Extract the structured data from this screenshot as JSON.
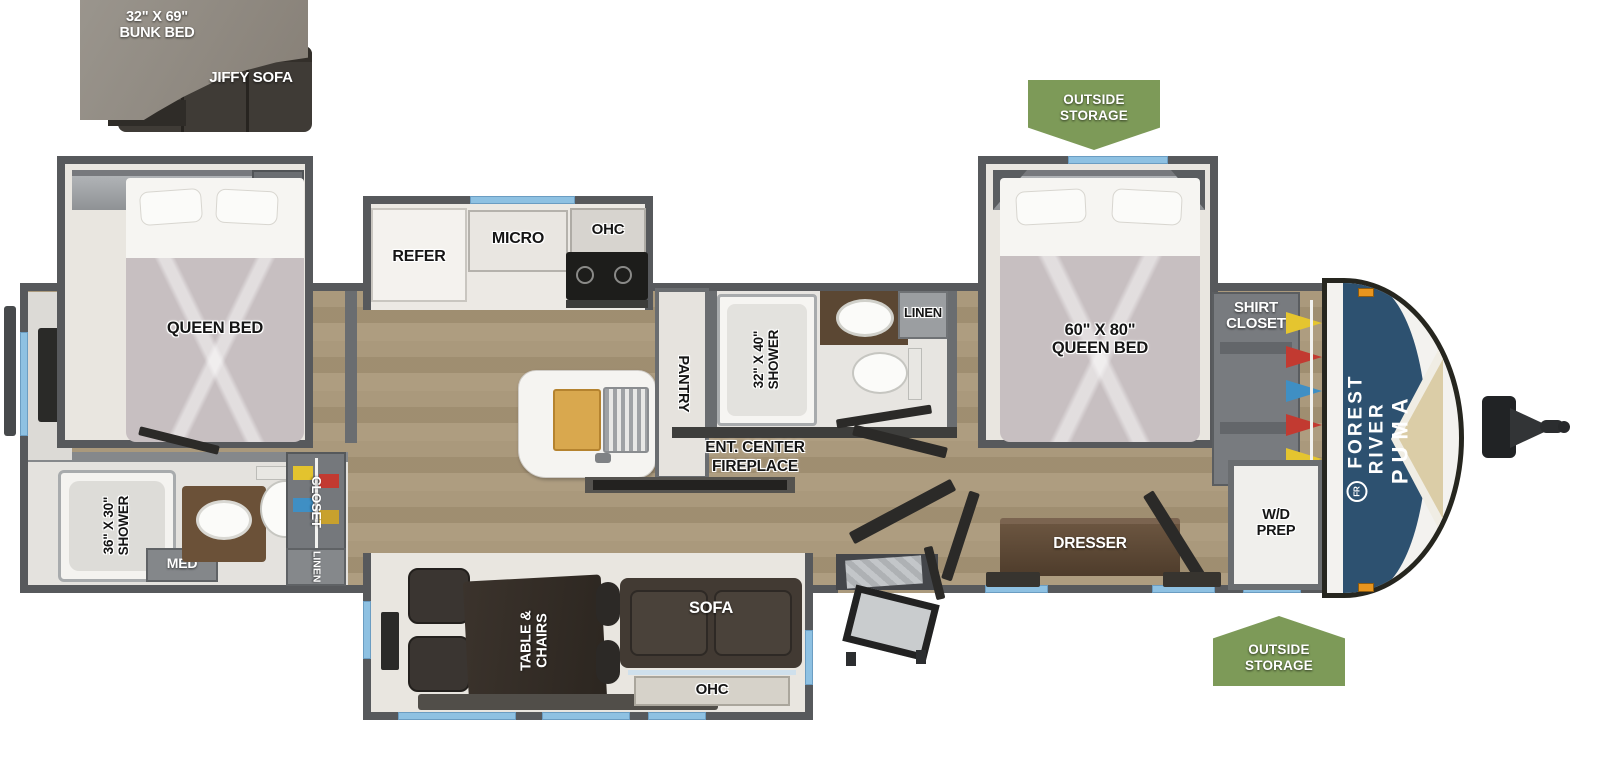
{
  "brand": {
    "name": "FOREST RIVER",
    "model": "PUMA",
    "logo": "FR"
  },
  "badges": {
    "top": "OUTSIDE\nSTORAGE",
    "bottom": "OUTSIDE\nSTORAGE"
  },
  "inset": {
    "bunk": "32\" X 69\"\nBUNK BED",
    "sofa": "JIFFY SOFA"
  },
  "rear_bedroom": {
    "ohc": "OHC",
    "linen": "LINEN",
    "bed": "QUEEN BED"
  },
  "rear_bath": {
    "shower": "36\" X 30\"\nSHOWER",
    "med": "MED",
    "closet": "CLOSET",
    "linen": "LINEN"
  },
  "kitchen": {
    "refer": "REFER",
    "micro": "MICRO",
    "ohc": "OHC",
    "pantry": "PANTRY"
  },
  "mid_bath": {
    "shower": "32\" X 40\"\nSHOWER",
    "linen": "LINEN"
  },
  "living": {
    "ent_center": "ENT. CENTER",
    "fireplace": "FIREPLACE",
    "table": "TABLE &\nCHAIRS",
    "sofa": "SOFA",
    "ohc": "OHC"
  },
  "front_bedroom": {
    "ohc": "OHC",
    "bed": "60\" X 80\"\nQUEEN BED",
    "shirt_closet": "SHIRT\nCLOSET",
    "dresser": "DRESSER",
    "wd": "W/D\nPREP"
  },
  "colors": {
    "badge_green": "#7d9a58",
    "window_blue": "#8ec1e2",
    "cap_blue": "#2d5170",
    "wall_gray": "#57595c",
    "floor_wood": "#cdc2ae",
    "accent_sand": "#dbcda7"
  }
}
